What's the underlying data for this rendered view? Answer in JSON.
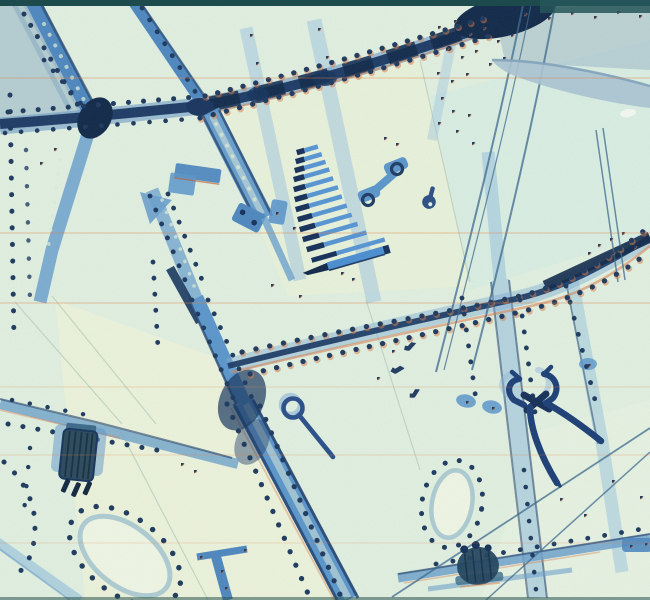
{
  "image": {
    "type": "x-ray-radiograph",
    "description": "Blue-cyan toned X-ray film of a riveted aircraft wing / fuselage structure with foreign-object tools visible inside",
    "objects": [
      {
        "name": "drill-bit-set",
        "count": 13,
        "position": "upper-center",
        "note": "graduated bars, dark tips, stacked stair pattern"
      },
      {
        "name": "pincer-pliers",
        "position": "center-right",
        "note": "curled jaws, crossed pivot, two diverging handles"
      },
      {
        "name": "eye-pin-tool",
        "position": "center",
        "note": "ring loop with straight shaft"
      },
      {
        "name": "hex-nuts",
        "count": 3,
        "position": "center"
      },
      {
        "name": "electrical-connector",
        "prongs": 3,
        "position": "lower-left",
        "note": "striated body, three prongs"
      },
      {
        "name": "bolted-fitting",
        "position": "bottom-center-right"
      },
      {
        "name": "small-key-tab",
        "position": "center-right"
      },
      {
        "name": "counterweight-sliver",
        "position": "top-right",
        "note": "pale curved crescent"
      },
      {
        "name": "lightening-hole-ovals",
        "count": 2,
        "note": "rivet rings around oval cutouts"
      },
      {
        "name": "spars-and-stringers",
        "note": "dark navy main spars crossing, light blue stringers"
      },
      {
        "name": "rivet-lines",
        "style": "dotted navy with orange fringing"
      },
      {
        "name": "control-cables",
        "note": "thin diagonal lines"
      },
      {
        "name": "scan-line-artifacts",
        "note": "horizontal orange chromatic streaks"
      }
    ]
  },
  "palette": {
    "background": "#dff0e2",
    "panel_yellow": "#f2f6d8",
    "panel_cyan": "#d2ebe6",
    "panel_bluegrey": "#a6c3cd",
    "band_blue": "#8fbede",
    "member_blue": "#4e88c0",
    "member_blue2": "#5b96cc",
    "navy": "#1f3c66",
    "dark_junction": "#12294a",
    "edge_teal": "#1d4a4d",
    "fringe_orange": "#d97e4a",
    "crescent": "#a9c3d4",
    "pale_hole": "#e4f2e0",
    "tool_navy": "#1d3f77"
  }
}
